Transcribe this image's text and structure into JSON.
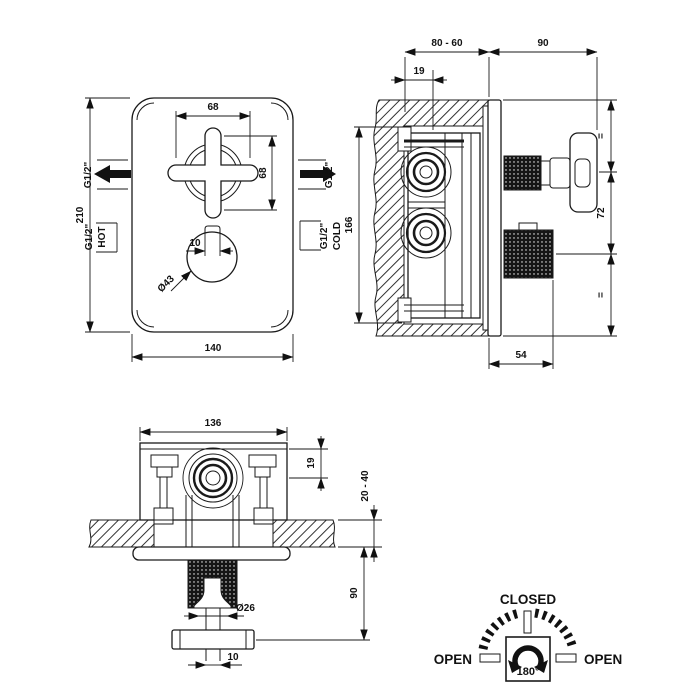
{
  "front_view": {
    "height": "210",
    "width": "140",
    "handle_width": "68",
    "handle_height": "68",
    "knob_tab_width": "10",
    "knob_diameter": "Ø43",
    "outlet_left_thread": "G1/2\"",
    "outlet_right_thread": "G1/2\"",
    "hot_thread": "G1/2\"",
    "hot_label": "HOT",
    "cold_thread": "G1/2\"",
    "cold_label": "COLD"
  },
  "side_view": {
    "recess_depth_range": "80 - 60",
    "handle_protrusion": "90",
    "bracket_offset": "19",
    "body_height": "166",
    "equal_top": "=",
    "handle_spacing": "72",
    "equal_bottom": "=",
    "knob_depth": "54"
  },
  "bottom_view": {
    "body_width": "136",
    "port_offset": "19",
    "wall_thickness_range": "20 - 40",
    "handle_distance": "90",
    "stem_diameter": "Ø26",
    "stem_width": "10"
  },
  "rotation_diagram": {
    "closed_label": "CLOSED",
    "open_left_label": "OPEN",
    "open_right_label": "OPEN",
    "angle_label": "180°"
  }
}
